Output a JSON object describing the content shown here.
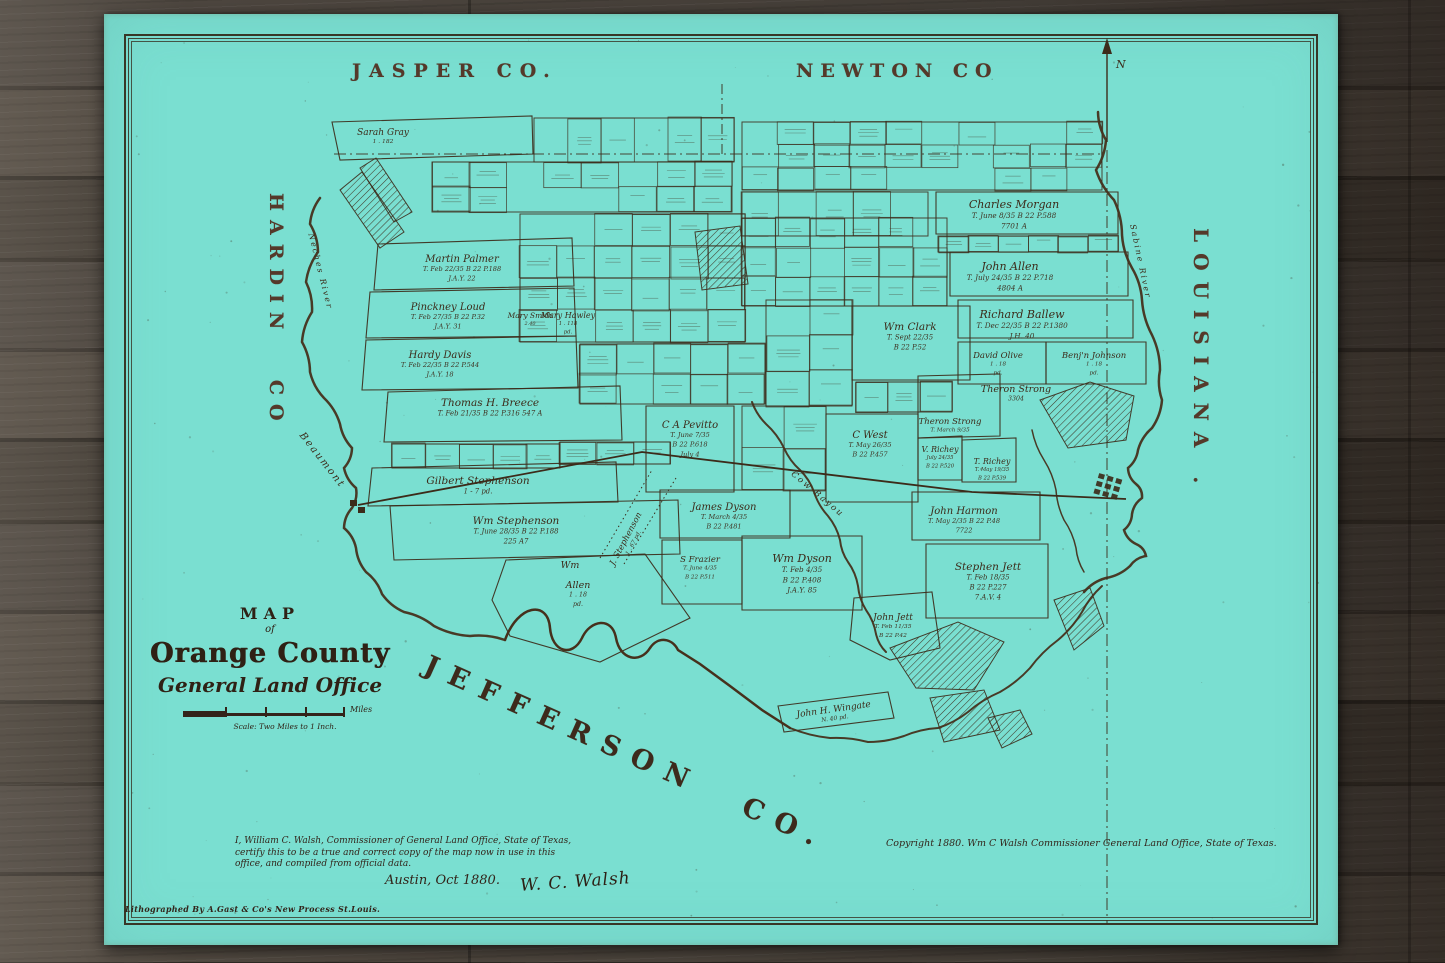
{
  "colors": {
    "paper_teal": "#7adfd1",
    "ink": "#3c2b1a",
    "wood": "#443e38",
    "county_label": "#55392a"
  },
  "map": {
    "neighbors": {
      "top_left": "JASPER CO.",
      "top_right": "NEWTON CO",
      "left": "HARDIN CO",
      "right": "LOUISIANA .",
      "bottom": "JEFFERSON CO."
    },
    "north_label": "N",
    "title_block": {
      "kicker": "MAP",
      "of": "of",
      "title": "Orange County",
      "subtitle": "General Land Office",
      "scale_units": "Miles",
      "scale_caption": "Scale: Two Miles to 1 Inch."
    },
    "certification": {
      "line1": "I, William C. Walsh, Commissioner of General Land Office, State of Texas,",
      "line2": "certify this to be a true and correct copy of the map now in use in this",
      "line3": "office, and compiled from official data.",
      "place_date": "Austin, Oct 1880.",
      "signature": "W. C. Walsh"
    },
    "copyright": "Copyright 1880. Wm C Walsh Commissioner General Land Office, State of Texas.",
    "lithographer": "Lithographed By A.Gast & Co's New Process St.Louis.",
    "water_labels": [
      {
        "text": "Sabine River",
        "x": 1138,
        "y": 262,
        "rot": 78,
        "size": 8
      },
      {
        "text": "Neches River",
        "x": 318,
        "y": 272,
        "rot": 76,
        "size": 8
      },
      {
        "text": "Cow Bayou",
        "x": 816,
        "y": 496,
        "rot": 40,
        "size": 8.5
      }
    ],
    "place_labels": [
      {
        "text": "Beaumont",
        "x": 320,
        "y": 462,
        "rot": 52,
        "size": 10
      }
    ],
    "plots": [
      {
        "name": "Sarah Gray",
        "x": 383,
        "y": 135,
        "size": 9,
        "lines": [
          "1 . 182"
        ]
      },
      {
        "name": "Martin Palmer",
        "x": 462,
        "y": 262,
        "size": 10,
        "lines": [
          "T. Feb 22/35      B 22  P.188",
          "J.A.Y. 22"
        ]
      },
      {
        "name": "Pinckney Loud",
        "x": 448,
        "y": 310,
        "size": 10,
        "lines": [
          "T. Feb 27/35      B 22  P.32",
          "J.A.Y. 31"
        ]
      },
      {
        "name": "Hardy Davis",
        "x": 440,
        "y": 358,
        "size": 10,
        "lines": [
          "T. Feb 22/35      B 22  P.544",
          "J.A.Y. 18"
        ]
      },
      {
        "name": "Thomas H. Breece",
        "x": 490,
        "y": 406,
        "size": 10.5,
        "lines": [
          "T. Feb 21/35      B 22  P.316      547 A"
        ]
      },
      {
        "name": "Gilbert Stephenson",
        "x": 478,
        "y": 484,
        "size": 10.5,
        "lines": [
          "1 - 7                    pd."
        ]
      },
      {
        "name": "Wm Stephenson",
        "x": 516,
        "y": 524,
        "size": 10.5,
        "lines": [
          "T. June 28/35   B 22  P.188",
          "225 A7"
        ]
      },
      {
        "name": "Wm",
        "x": 570,
        "y": 568,
        "size": 9.5,
        "lines": []
      },
      {
        "name": "Allen",
        "x": 578,
        "y": 588,
        "size": 9.5,
        "lines": [
          "1 . 18",
          "pd."
        ]
      },
      {
        "name": "J. Stephenson",
        "x": 628,
        "y": 540,
        "size": 8.5,
        "rot": -62,
        "lines": [
          "1 . 67   pd."
        ]
      },
      {
        "name": "C A Pevitto",
        "x": 690,
        "y": 428,
        "size": 10,
        "lines": [
          "T. June 7/35",
          "B 22   P.618",
          "July 4"
        ]
      },
      {
        "name": "James Dyson",
        "x": 724,
        "y": 510,
        "size": 10,
        "lines": [
          "T. March 4/35",
          "B 22  P.481"
        ]
      },
      {
        "name": "S Frazier",
        "x": 700,
        "y": 562,
        "size": 8.5,
        "lines": [
          "T. June 4/35",
          "B 22  P.511"
        ]
      },
      {
        "name": "Wm Dyson",
        "x": 802,
        "y": 562,
        "size": 11,
        "lines": [
          "T. Feb 4/35",
          "B 22     P.408",
          "J.A.Y. 85"
        ]
      },
      {
        "name": "C West",
        "x": 870,
        "y": 438,
        "size": 10,
        "lines": [
          "T. May 26/35",
          "B 22   P.457"
        ]
      },
      {
        "name": "Wm Clark",
        "x": 910,
        "y": 330,
        "size": 10.5,
        "lines": [
          "T. Sept 22/35",
          "B 22   P.52"
        ]
      },
      {
        "name": "Charles Morgan",
        "x": 1014,
        "y": 208,
        "size": 11,
        "lines": [
          "T. June 8/35      B 22  P.588",
          "7701 A"
        ]
      },
      {
        "name": "John Allen",
        "x": 1010,
        "y": 270,
        "size": 11,
        "lines": [
          "T. July 24/35     B 22  P.718",
          "4804 A"
        ]
      },
      {
        "name": "Richard Ballew",
        "x": 1022,
        "y": 318,
        "size": 11,
        "lines": [
          "T. Dec 22/35     B 22  P.1380",
          "J.H. 40"
        ]
      },
      {
        "name": "David Olive",
        "x": 998,
        "y": 358,
        "size": 8.5,
        "lines": [
          "1 . 18",
          "pd."
        ]
      },
      {
        "name": "Benj'n Johnson",
        "x": 1094,
        "y": 358,
        "size": 8.5,
        "lines": [
          "1 . 18",
          "pd."
        ]
      },
      {
        "name": "Theron Strong",
        "x": 1016,
        "y": 392,
        "size": 9.5,
        "lines": [
          "3304"
        ]
      },
      {
        "name": "Theron Strong",
        "x": 950,
        "y": 424,
        "size": 8.5,
        "lines": [
          "T. March 9/35"
        ]
      },
      {
        "name": "V. Richey",
        "x": 940,
        "y": 452,
        "size": 8,
        "lines": [
          "July 24/35",
          "B 22  P.520"
        ]
      },
      {
        "name": "T. Richey",
        "x": 992,
        "y": 464,
        "size": 8,
        "lines": [
          "T. May 19/35",
          "B 22  P.539"
        ]
      },
      {
        "name": "John Harmon",
        "x": 964,
        "y": 514,
        "size": 10,
        "lines": [
          "T. May 2/35     B 22  P.48",
          "7722"
        ]
      },
      {
        "name": "Stephen Jett",
        "x": 988,
        "y": 570,
        "size": 10.5,
        "lines": [
          "T. Feb 18/35",
          "B 22    P.227",
          "7.A.V. 4"
        ]
      },
      {
        "name": "John Jett",
        "x": 893,
        "y": 620,
        "size": 9,
        "lines": [
          "T. Feb 11/35",
          "B 22  P.42"
        ]
      },
      {
        "name": "John H. Wingate",
        "x": 834,
        "y": 712,
        "size": 9,
        "rot": -8,
        "lines": [
          "N. 40          pd."
        ]
      },
      {
        "name": "Mary Smith",
        "x": 530,
        "y": 318,
        "size": 7.5,
        "lines": [
          "2.40"
        ]
      },
      {
        "name": "Mary Hawley",
        "x": 568,
        "y": 318,
        "size": 8,
        "lines": [
          "1 . 118",
          "pd."
        ]
      }
    ]
  }
}
